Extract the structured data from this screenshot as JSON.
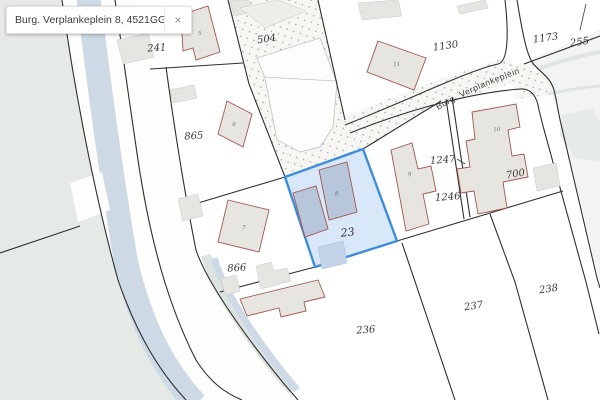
{
  "search": {
    "query": "Burg. Verplankeplein 8, 4521GG Bier",
    "close_label": "×"
  },
  "street": {
    "name": "Burg. Verplankeplein"
  },
  "map": {
    "selected_parcel": "23",
    "parcels": {
      "p241": "241",
      "p504": "504",
      "p1130": "1130",
      "p1173": "1173",
      "p255": "255",
      "p865": "865",
      "p866": "866",
      "p236": "236",
      "p237": "237",
      "p238": "238",
      "p700": "700",
      "p1247": "1247",
      "p1246": "1246",
      "p23": "23"
    },
    "buildings": {
      "b5": "5",
      "b6": "6",
      "b7": "7",
      "b8": "8",
      "b9": "9",
      "b10": "10",
      "b11": "11"
    },
    "colors": {
      "selection_fill": "#d2e4f7",
      "selection_stroke": "#3e8ddb",
      "building_fill": "#e7e5e0",
      "building_stroke": "#a3564f",
      "selected_building_fill": "#b7c6db",
      "water": "#cdd9e4",
      "greenspace": "#e6eae6",
      "boundary": "#2f2f2f"
    }
  }
}
